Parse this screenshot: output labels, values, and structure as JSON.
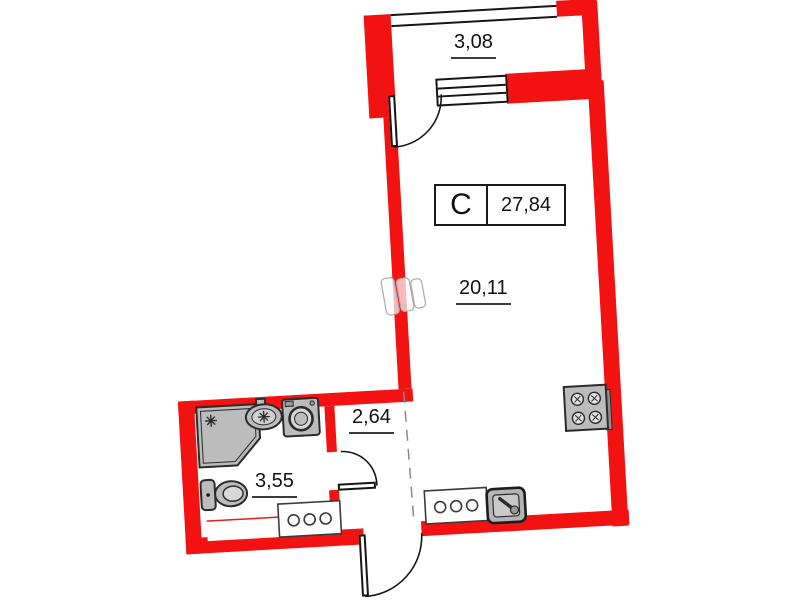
{
  "unit": {
    "type_code": "С",
    "total_area": "27,84"
  },
  "rooms": {
    "balcony": {
      "area": "3,08"
    },
    "living_room": {
      "area": "20,11"
    },
    "hallway": {
      "area": "2,64"
    },
    "bathroom": {
      "area": "3,55"
    }
  },
  "fixtures": [
    "shower",
    "washbasin",
    "washing-machine",
    "toilet",
    "radiator",
    "stove",
    "kitchen-counter",
    "kitchen-sink",
    "bathroom-counter"
  ],
  "colors": {
    "wall_red": "#f21212",
    "fixture_gray": "#bcbcbc",
    "outline": "#2b2b2b",
    "label_text": "#111111"
  }
}
